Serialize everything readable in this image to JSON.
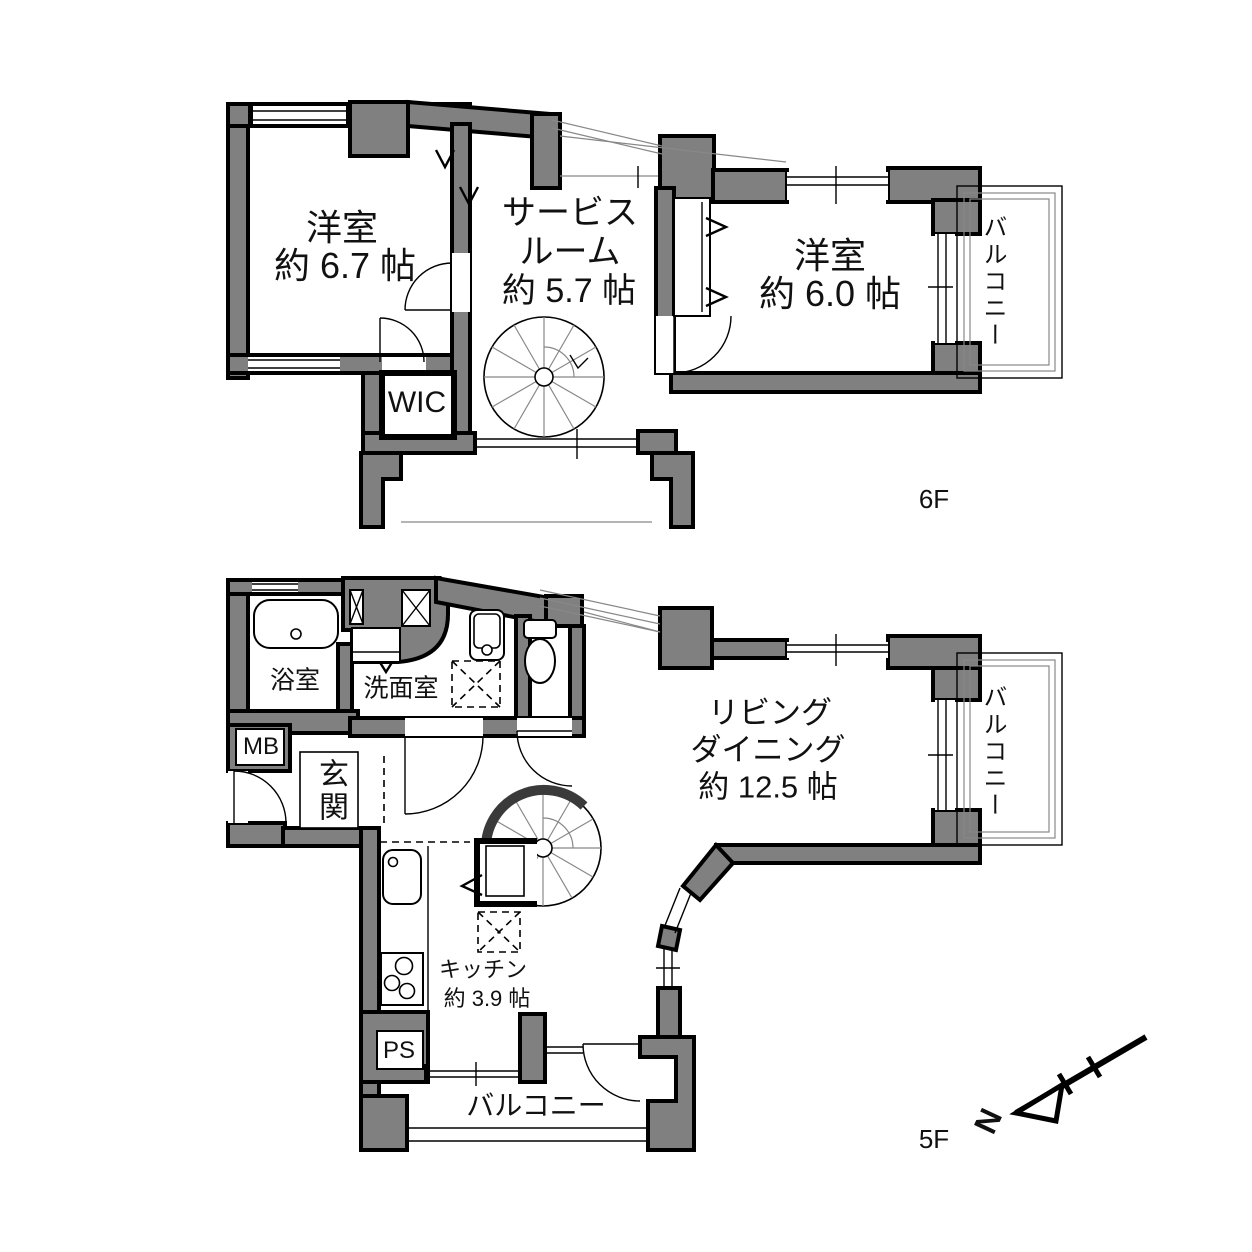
{
  "colors": {
    "wall_fill": "#808080",
    "wall_outline": "#000000",
    "background": "#ffffff",
    "thin_line": "#888888",
    "text": "#111111"
  },
  "floors": {
    "upper": {
      "label": "6F",
      "rooms": {
        "bedroom_west": {
          "name": "洋室",
          "size": "約 6.7 帖"
        },
        "service_room": {
          "name_line1": "サービス",
          "name_line2": "ルーム",
          "size": "約 5.7 帖"
        },
        "bedroom_east": {
          "name": "洋室",
          "size": "約 6.0 帖"
        },
        "wic": {
          "name": "WIC"
        },
        "balcony_east": {
          "name": "バルコニー"
        }
      }
    },
    "lower": {
      "label": "5F",
      "rooms": {
        "bathroom": {
          "name": "浴室"
        },
        "washroom": {
          "name": "洗面室"
        },
        "entrance": {
          "name": "玄関"
        },
        "meter_box": {
          "name": "MB"
        },
        "living_dining": {
          "name_line1": "リビング",
          "name_line2": "ダイニング",
          "size": "約 12.5 帖"
        },
        "kitchen": {
          "name": "キッチン",
          "size": "約 3.9 帖"
        },
        "pipe_space": {
          "name": "PS"
        },
        "balcony_south": {
          "name": "バルコニー"
        },
        "balcony_east": {
          "name": "バルコニー"
        }
      }
    }
  },
  "compass": {
    "north_label": "N"
  }
}
